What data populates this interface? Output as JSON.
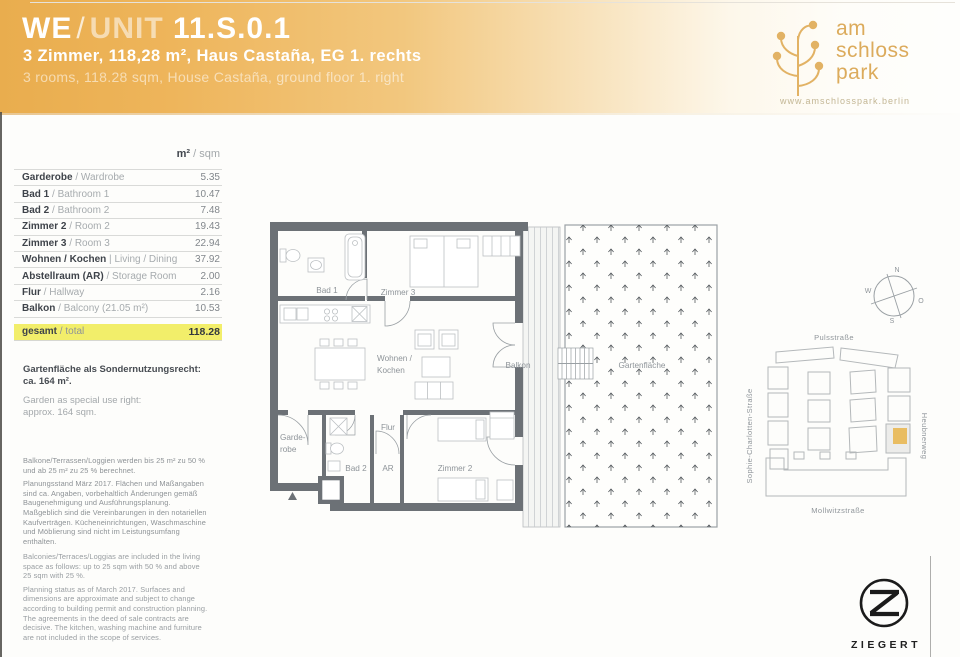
{
  "header": {
    "title_we": "WE",
    "title_sep": "/",
    "title_unit": "UNIT",
    "title_number": "11.S.0.1",
    "subtitle_de": "3 Zimmer, 118,28 m², Haus Castaña, EG 1. rechts",
    "subtitle_en": "3 rooms, 118.28 sqm, House Castaña, ground floor 1. right",
    "accent_color": "#e9ad4e",
    "logo": {
      "line1": "am",
      "line2": "schloss",
      "line3": "park",
      "website": "www.amschlosspark.berlin"
    }
  },
  "area_table": {
    "unit_de": "m²",
    "unit_sep": "/",
    "unit_en": "sqm",
    "rows": [
      {
        "de": "Garderobe",
        "sep": "/",
        "en": "Wardrobe",
        "value": "5.35"
      },
      {
        "de": "Bad 1",
        "sep": "/",
        "en": "Bathroom 1",
        "value": "10.47"
      },
      {
        "de": "Bad 2",
        "sep": "/",
        "en": "Bathroom 2",
        "value": "7.48"
      },
      {
        "de": "Zimmer 2",
        "sep": "/",
        "en": "Room 2",
        "value": "19.43"
      },
      {
        "de": "Zimmer 3",
        "sep": "/",
        "en": "Room 3",
        "value": "22.94"
      },
      {
        "de": "Wohnen / Kochen",
        "sep": "|",
        "en": "Living / Dining",
        "value": "37.92"
      },
      {
        "de": "Abstellraum (AR)",
        "sep": "/",
        "en": "Storage Room",
        "value": "2.00"
      },
      {
        "de": "Flur",
        "sep": "/",
        "en": "Hallway",
        "value": "2.16"
      },
      {
        "de": "Balkon",
        "sep": "/",
        "en": "Balcony  (21.05 m²)",
        "value": "10.53"
      }
    ],
    "total": {
      "de": "gesamt",
      "sep": "/",
      "en": "total",
      "value": "118.28",
      "highlight_color": "#f2ee6a"
    }
  },
  "garden_note": {
    "de": "Gartenfläche als Sondernutzungsrecht:\nca. 164 m².",
    "en": "Garden as special use right:\napprox. 164 sqm."
  },
  "disclaimer_de": {
    "p1": "Balkone/Terrassen/Loggien werden bis 25 m² zu 50 % und ab 25 m² zu 25 % berechnet.",
    "p2": "Planungsstand März 2017. Flächen und Maßangaben sind ca. Angaben, vorbehaltlich Änderungen gemäß Baugenehmigung und Ausführungsplanung. Maßgeblich sind die Vereinbarungen in den notariellen Kaufverträgen. Kücheneinrichtungen, Waschmaschine und Möblierung sind nicht im Leistungsumfang enthalten."
  },
  "disclaimer_en": {
    "p1": "Balconies/Terraces/Loggias are included in the living space as follows: up to 25 sqm with 50 % and above 25 sqm with 25 %.",
    "p2": "Planning status as of March 2017. Surfaces and dimensions are approximate and subject to change according to building permit and construction planning. The agreements in the deed of sale contracts are decisive. The kitchen, washing machine and furniture are not included in the scope of services."
  },
  "floorplan": {
    "labels": {
      "bad1": "Bad 1",
      "zimmer3": "Zimmer 3",
      "wohnen_l1": "Wohnen /",
      "wohnen_l2": "Kochen",
      "garderobe_l1": "Garde-",
      "garderobe_l2": "robe",
      "bad2": "Bad 2",
      "flur": "Flur",
      "ar": "AR",
      "zimmer2": "Zimmer 2",
      "balkon": "Balkon",
      "garten": "Gartenfläche"
    }
  },
  "compass": {
    "n": "N",
    "w": "W",
    "o": "O",
    "s": "S"
  },
  "site_map": {
    "street_top": "Pulsstraße",
    "street_left": "Sophie-Charlotten-Straße",
    "street_right": "Heubnerweg",
    "street_bottom": "Mollwitzstraße",
    "highlight_color": "#e9bd62"
  },
  "footer": {
    "brand": "ZIEGERT"
  }
}
